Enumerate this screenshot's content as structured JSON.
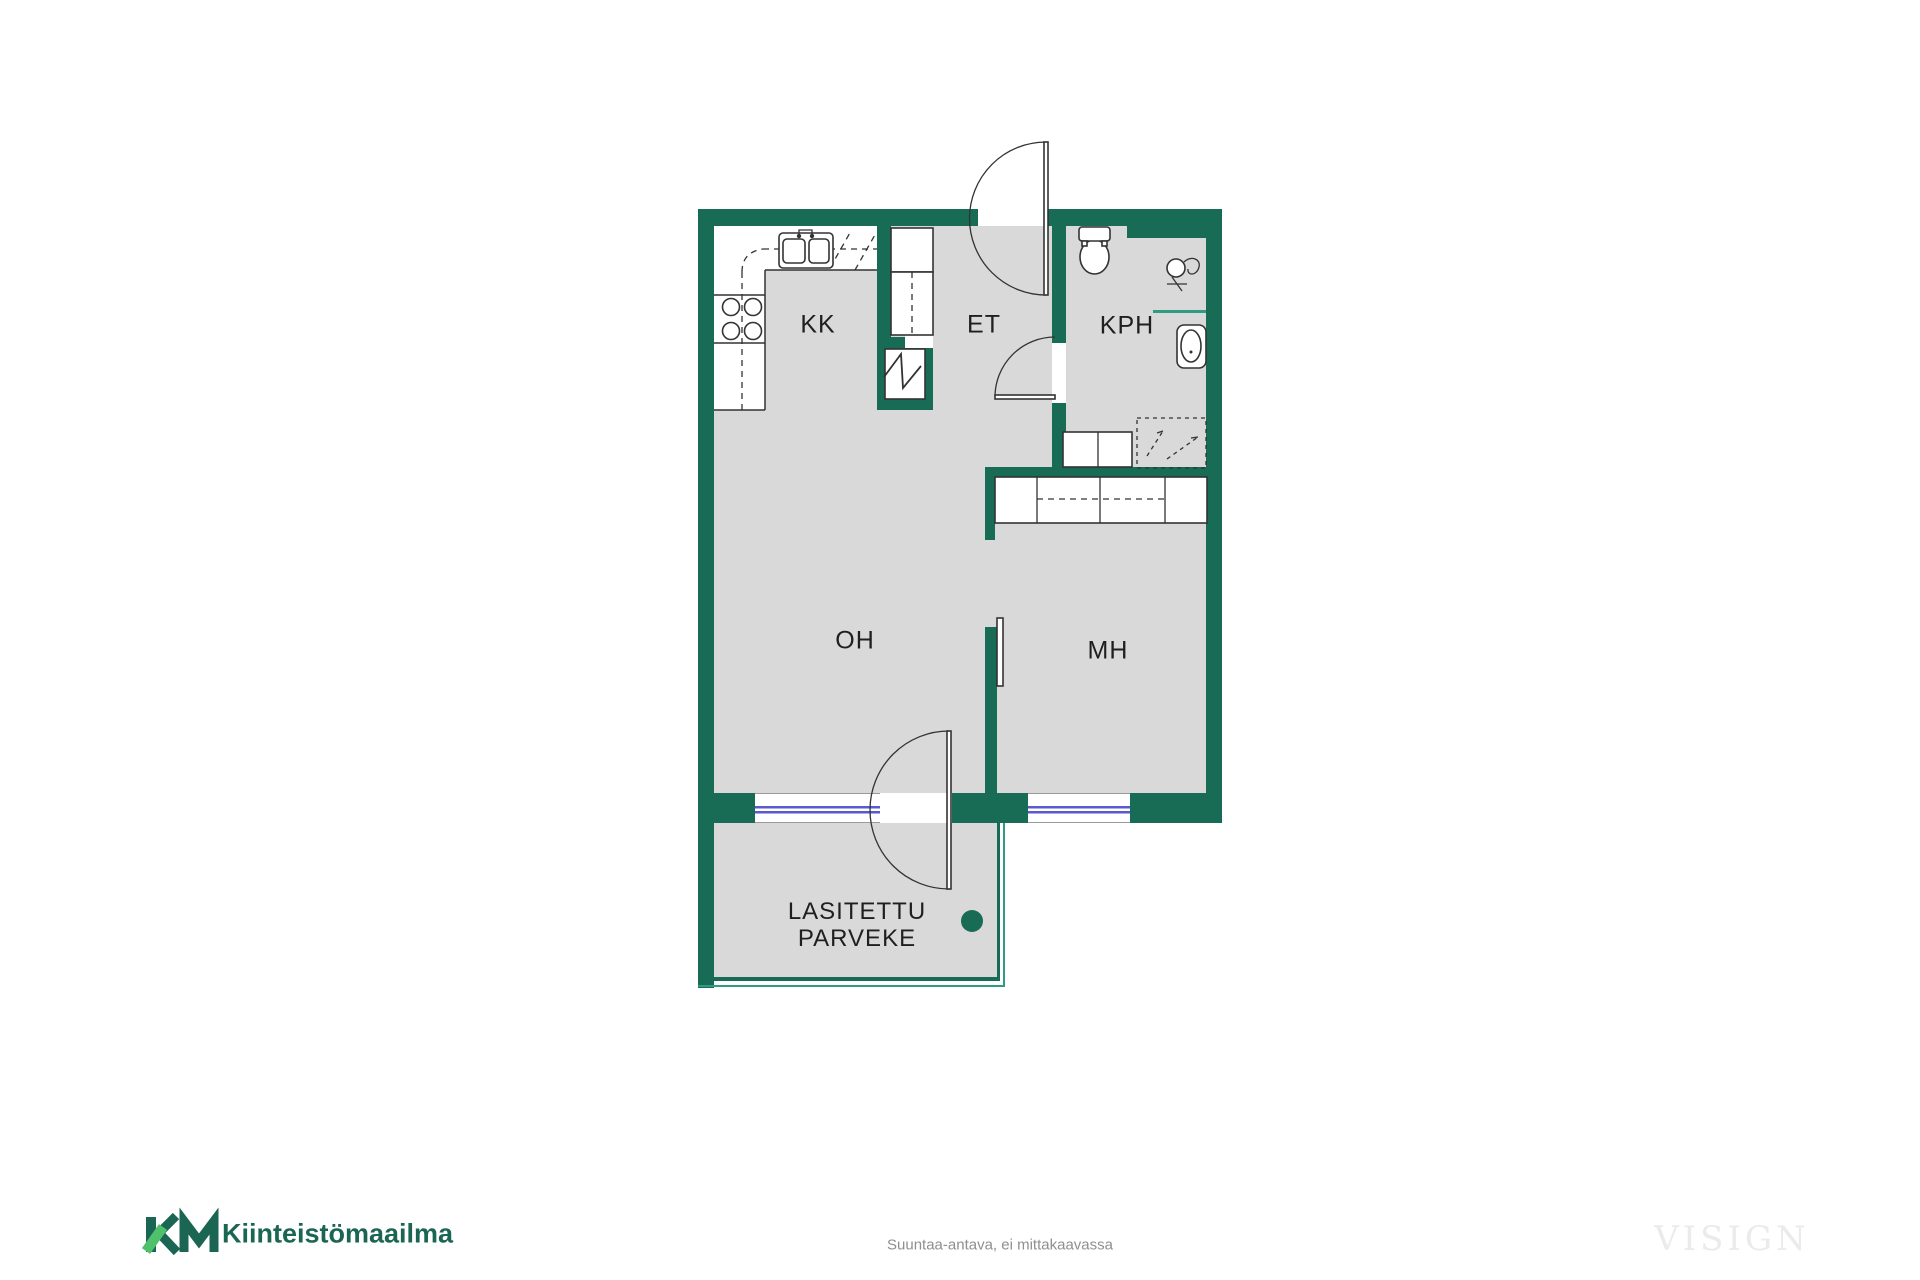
{
  "plan": {
    "rooms": [
      {
        "id": "kk",
        "label": "KK"
      },
      {
        "id": "et",
        "label": "ET"
      },
      {
        "id": "kph",
        "label": "KPH"
      },
      {
        "id": "oh",
        "label": "OH"
      },
      {
        "id": "mh",
        "label": "MH"
      }
    ],
    "balcony": {
      "line1": "LASITETTU",
      "line2": "PARVEKE"
    }
  },
  "footer": {
    "disclaimer": "Suuntaa-antava, ei mittakaavassa",
    "brand_name": "Kiinteistömaailma",
    "watermark": "VISIGN"
  },
  "colors": {
    "wall": "#186B55",
    "floor": "#D9D9D9",
    "line": "#333333",
    "window": "#5A5AD0",
    "glazing": "#2F9B82",
    "accent": "#4FC16C",
    "brand_text": "#1A6653",
    "muted_text": "#8F8F8F",
    "watermark_text": "#ECEAEA",
    "label_text": "#1F1F1F"
  }
}
